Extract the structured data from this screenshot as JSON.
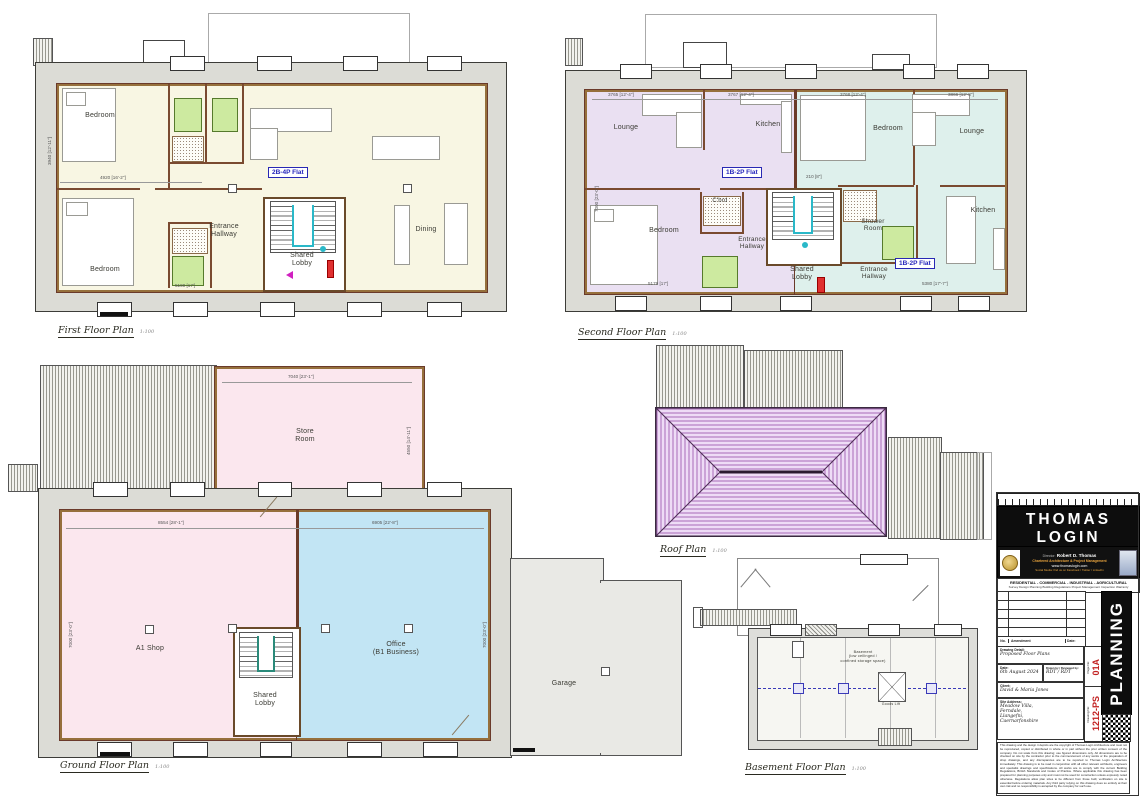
{
  "first": {
    "badge": "2B-4P Flat",
    "bedroom_top": "Bedroom",
    "bedroom_bottom": "Bedroom",
    "entrance_hallway": "Entrance\nHallway",
    "shared_lobby": "Shared\nLobby",
    "dining": "Dining",
    "dim_top": "4920 [16'-2\"]",
    "dim_bottom": "5190 [17']",
    "dim_left": "3940 [12'-11\"]",
    "caption": "First Floor Plan",
    "scale": "1:100"
  },
  "second": {
    "badge_left": "1B-2P Flat",
    "badge_right": "1B-2P Flat",
    "lounge_left": "Lounge",
    "kitchen_left": "Kitchen",
    "bedroom_left": "Bedroom",
    "cupboard": "C'brd",
    "entrance_left": "Entrance\nHallway",
    "shared_lobby": "Shared\nLobby",
    "entrance_right": "Entrance\nHallway",
    "shower_room": "Shower\nRoom",
    "bedroom_right": "Bedroom",
    "lounge_right": "Lounge",
    "kitchen_right": "Kitchen",
    "dim_t1": "3765 [12'-4\"]",
    "dim_t2": "3767 [12'-4\"]",
    "dim_t3": "3768 [12'-4\"]",
    "dim_t4": "3866 [12'-8\"]",
    "dim_mid": "210 [8\"]",
    "dim_b1": "5179 [17']",
    "dim_b2": "5380 [17'-7\"]",
    "dim_left": "7000 [23'-0\"]",
    "caption": "Second Floor Plan",
    "scale": "1:100"
  },
  "ground": {
    "store_room": "Store\nRoom",
    "shop": "A1 Shop",
    "office": "Office\n(B1 Business)",
    "shared_lobby": "Shared\nLobby",
    "dim_store_top": "7040 [23'-1\"]",
    "dim_store_right": "4550 [14'-11\"]",
    "dim_shop": "8554 [28'-1\"]",
    "dim_office": "6905 [22'-8\"]",
    "dim_left": "7000 [23'-0\"]",
    "dim_right": "7000 [23'-0\"]",
    "caption": "Ground Floor Plan",
    "scale": "1:100"
  },
  "roof": {
    "caption": "Roof Plan",
    "scale": "1:100"
  },
  "garage": {
    "label": "Garage"
  },
  "basement": {
    "note": "Basement\n(low ceilinged /\nconfined storage space)",
    "lift": "Goods Lift",
    "caption": "Basement Floor Plan",
    "scale": "1:100"
  },
  "title_block": {
    "firm_name": "THOMAS LOGIN",
    "firm_sub": "ARCHITECTURE",
    "director_label": "Director:",
    "director": "Robert D. Thomas",
    "line_chartered": "Chartered Architecture & Project Management",
    "line_web": "www.thomaslogin.com",
    "line_social": "Social Media: find us on Facebook / Twitter / LinkedIn",
    "sectors": "RESIDENTIAL  -  COMMERCIAL  -  INDUSTRIAL  -  AGRICULTURAL",
    "services": "Survey  Design  Planning  Building Regulations  Project Management  Inspection  Warranty",
    "amend_no": "No.",
    "amend_label": "Amendment",
    "amend_date": "Date:",
    "drawing_detail_label": "Drawing Detail:",
    "drawing_detail": "Proposed Floor Plans",
    "date_label": "Date:",
    "date": "6th August 2024",
    "drawn_label": "Drawn by / Reviewed by:",
    "drawn": "RDT / RDT",
    "client_label": "Client:",
    "client": "David & Maria Jones",
    "site_label": "Site Address:",
    "site": "Meadow Villa,\nFerndale,\nLlangefni,\nCaernarfonshire",
    "page_label": "Page No:",
    "page_no": "01A",
    "drawing_no_label": "Drawing No:",
    "drawing_no": "1212-PS",
    "planning": "PLANNING",
    "disclaimer": "This drawing and the design it depicts are the copyright of Thomas Login Architecture and must not be reproduced, copied or distributed in whole or in part without the prior written consent of the company. Do not scale from this drawing; use figured dimensions only. All dimensions are to be checked on site by the contractor prior to the commencement of any works or the preparation of shop drawings, and any discrepancies are to be reported to Thomas Login Architecture immediately. This drawing is to be read in conjunction with all other relevant architects, engineers and specialist drawings and specifications. All works are to comply with the current Building Regulations, British Standards and Codes of Practice. Where applicable this drawing has been prepared for planning purposes only and must not be used for construction unless expressly noted otherwise. Regulations allow plan sizes to be different from those built; verification on site is essential before ordering materials. Any third party relying on this drawing does so entirely at their own risk and no responsibility is accepted by the company for such use."
  }
}
